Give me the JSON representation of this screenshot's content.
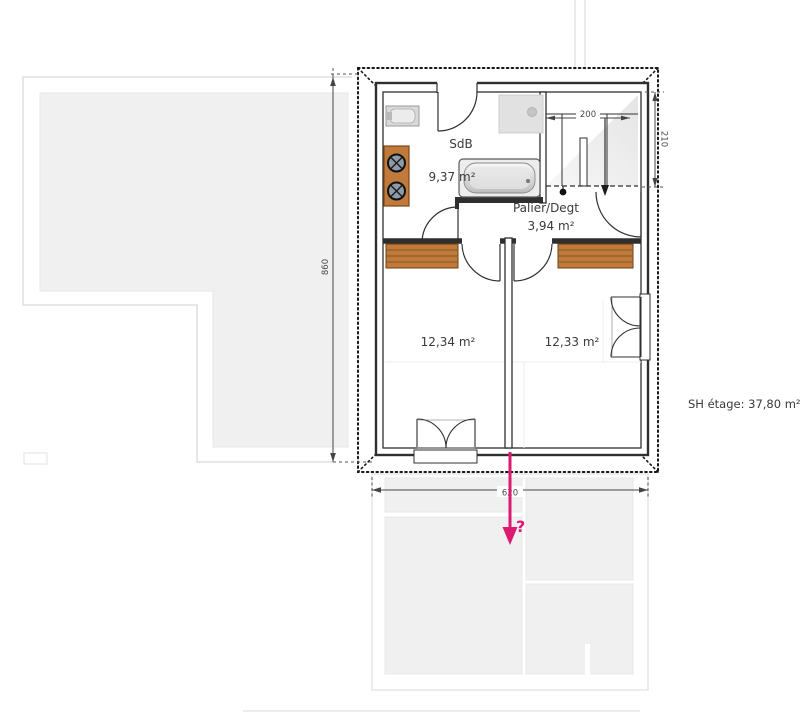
{
  "plan": {
    "summary_note": "SH étage: 37,80 m²",
    "rooms": {
      "bathroom": {
        "name": "SdB",
        "area": "9,37 m²"
      },
      "landing": {
        "name": "Palier/Degt",
        "area": "3,94 m²"
      },
      "bedroom_left": {
        "area": "12,34 m²"
      },
      "bedroom_right": {
        "area": "12,33 m²"
      }
    },
    "dimensions": {
      "overall_height": "860",
      "overall_width": "620",
      "stair_width": "200",
      "stair_depth": "210"
    },
    "annotation": {
      "question_mark": "?"
    },
    "colors": {
      "annotation": "#dd1a72",
      "wood": "#bf7a3c",
      "wood_dark": "#8a5420",
      "ghost_fill": "#f0f0f0",
      "wall": "#2f2f2f"
    }
  }
}
